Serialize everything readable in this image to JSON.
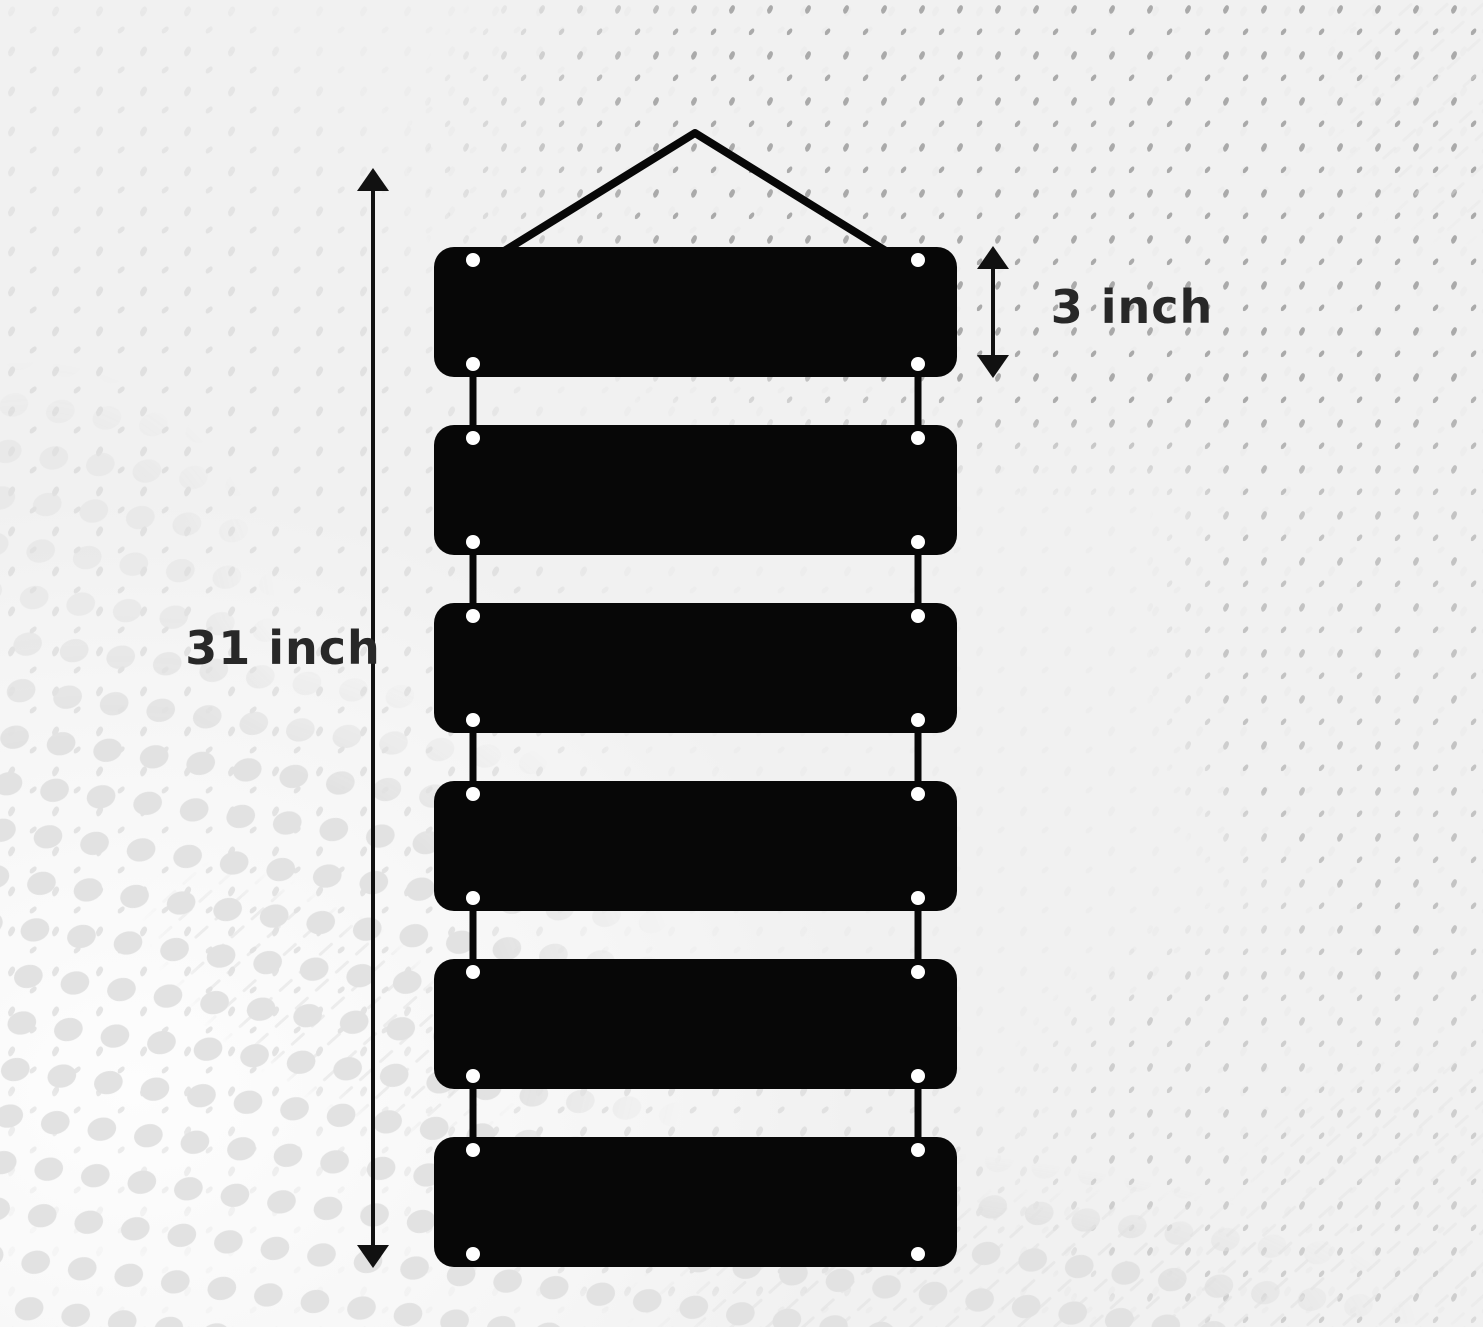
{
  "page": {
    "background_color": "#f1f1f1",
    "style": "halftone-dot-swirl-backdrop"
  },
  "labels": {
    "total_height": "31 inch",
    "slat_height": "3 inch"
  },
  "sign": {
    "slat_count": 6,
    "holes_per_slat": 4,
    "slat_color": "#070707",
    "string_color": "#070707",
    "hole_color": "#ffffff",
    "dimension_color": "#111111",
    "label_color": "#282828",
    "halftone_dot_color": "#e2e2e2",
    "speck_color": "#9e9e9e",
    "light_speck_color": "#dcdcdc"
  }
}
